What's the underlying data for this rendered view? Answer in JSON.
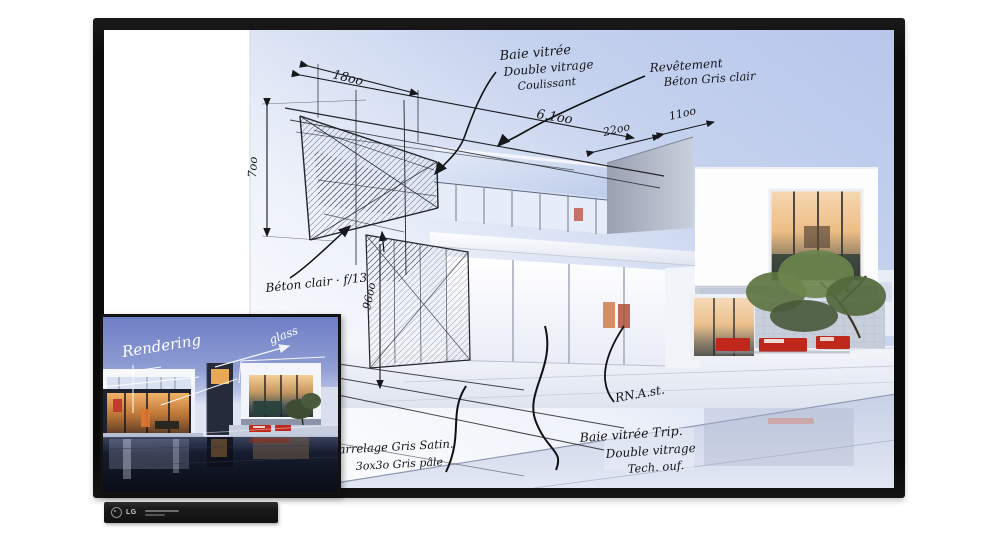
{
  "device": {
    "brand_logo": "LG"
  },
  "tv": {
    "annotations": {
      "dim_top_left": "18oo",
      "dim_left_vertical": "7oo",
      "dim_long_span": "6.1oo",
      "dim_parapet": "22oo",
      "dim_parapet_right": "11oo",
      "dim_mid_vertical": "96oo",
      "note_glazing_l1": "Baie vitrée",
      "note_glazing_l2": "Double vitrage",
      "note_glazing_l3": "Coulissant",
      "note_cladding_l1": "Revêtement",
      "note_cladding_l2": "Béton Gris clair",
      "note_concrete": "Béton clair · f/13",
      "note_tiles_l1": "Carrelage Gris Satin.",
      "note_tiles_l2": "3ox3o Gris pâle",
      "note_triple_l1": "Baie vitrée Trip.",
      "note_triple_l2": "Double vitrage",
      "note_triple_l3": "Tech. ouf.",
      "note_scribble": "RN.A.st."
    }
  },
  "inset": {
    "label_rendering": "Rendering",
    "label_glass": "glass"
  },
  "colors": {
    "accent_red": "#c0281c",
    "sky_blue": "#b7c6ec",
    "dusk_blue": "#6e7ec4",
    "warm_glow": "#edbd85",
    "tree_green": "#5d7442",
    "ink": "#17181c",
    "bezel": "#0d0d0d"
  }
}
